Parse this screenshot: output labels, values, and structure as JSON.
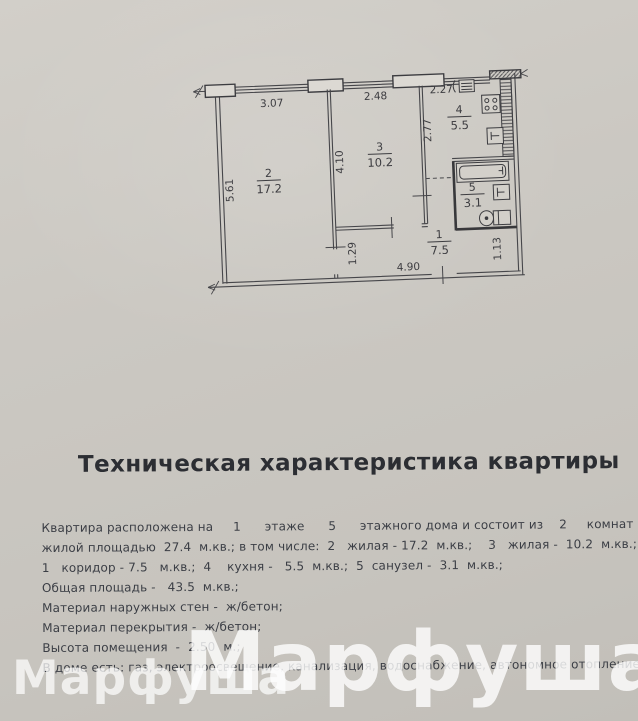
{
  "page": {
    "title": "Техническая характеристика квартиры",
    "lines": [
      "Квартира расположена на     1      этаже      5      этажного дома и состоит из    2     комнат",
      "жилой площадью  27.4  м.кв.; в том числе:  2   жилая - 17.2  м.кв.;    3   жилая -  10.2  м.кв.;",
      "1   коридор - 7.5   м.кв.;  4    кухня -   5.5  м.кв.;  5  санузел -  3.1  м.кв.;",
      "Общая площадь -   43.5  м.кв.;",
      "Материал наружных стен -  ж/бетон;",
      "Материал перекрытия -  ж/бетон;",
      "Высота помещения  -  2.50  м.;",
      "В доме есть: газ, электроосвещение, канализация, водоснабжение, автономное отопление."
    ],
    "watermark_small": "Марфуша",
    "watermark_large": "Марфуша"
  },
  "plan": {
    "line_color": "#46464a",
    "rooms": {
      "r1": {
        "num": "1",
        "area": "7.5"
      },
      "r2": {
        "num": "2",
        "area": "17.2"
      },
      "r3": {
        "num": "3",
        "area": "10.2"
      },
      "r4": {
        "num": "4",
        "area": "5.5"
      },
      "r5": {
        "num": "5",
        "area": "3.1"
      }
    },
    "dims": {
      "top_room2": "3.07",
      "top_room3": "2.48",
      "top_kitchen": "2.27",
      "left_room2": "5.61",
      "room3_height": "4.10",
      "kitchen_height": "2.77",
      "corridor_left": "1.29",
      "corridor_width": "4.90",
      "corridor_right": "1.13"
    }
  }
}
